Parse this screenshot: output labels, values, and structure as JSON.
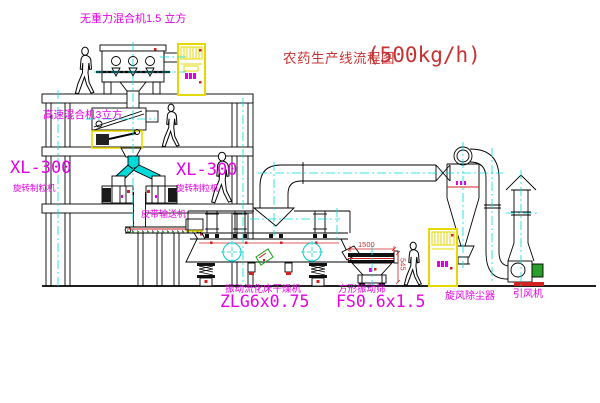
{
  "title": {
    "text": "农药生产线流程图",
    "capacity": "(500kg/h)"
  },
  "equipment_labels": {
    "gravity_free_mixer": "无重力混合机1.5 立方",
    "high_speed_mixer": "高速混合机3立方",
    "granulator_left_model": "XL-300",
    "granulator_left_name": "旋转制粒机",
    "granulator_right_model": "XL-300",
    "granulator_right_name": "旋转制粒机",
    "belt_conveyor": "皮带输送机",
    "fluid_bed_dryer_name": "振动流化床干燥机",
    "fluid_bed_dryer_model": "ZLG6x0.75",
    "vibrating_screen_name": "方形振动筛",
    "vibrating_screen_model": "FS0.6x1.5",
    "cyclone_dust_collector": "旋风除尘器",
    "induced_draft_fan": "引风机"
  },
  "dimensions": {
    "screen_length": "1500",
    "screen_height": "545"
  },
  "colors": {
    "label_magenta": "#e400e4",
    "title_red": "#c83232",
    "centerline_cyan": "#00dcdc",
    "cabinet_yellow": "#e6d800",
    "detail_red": "#d22222",
    "motor_green": "#2aa02a"
  }
}
